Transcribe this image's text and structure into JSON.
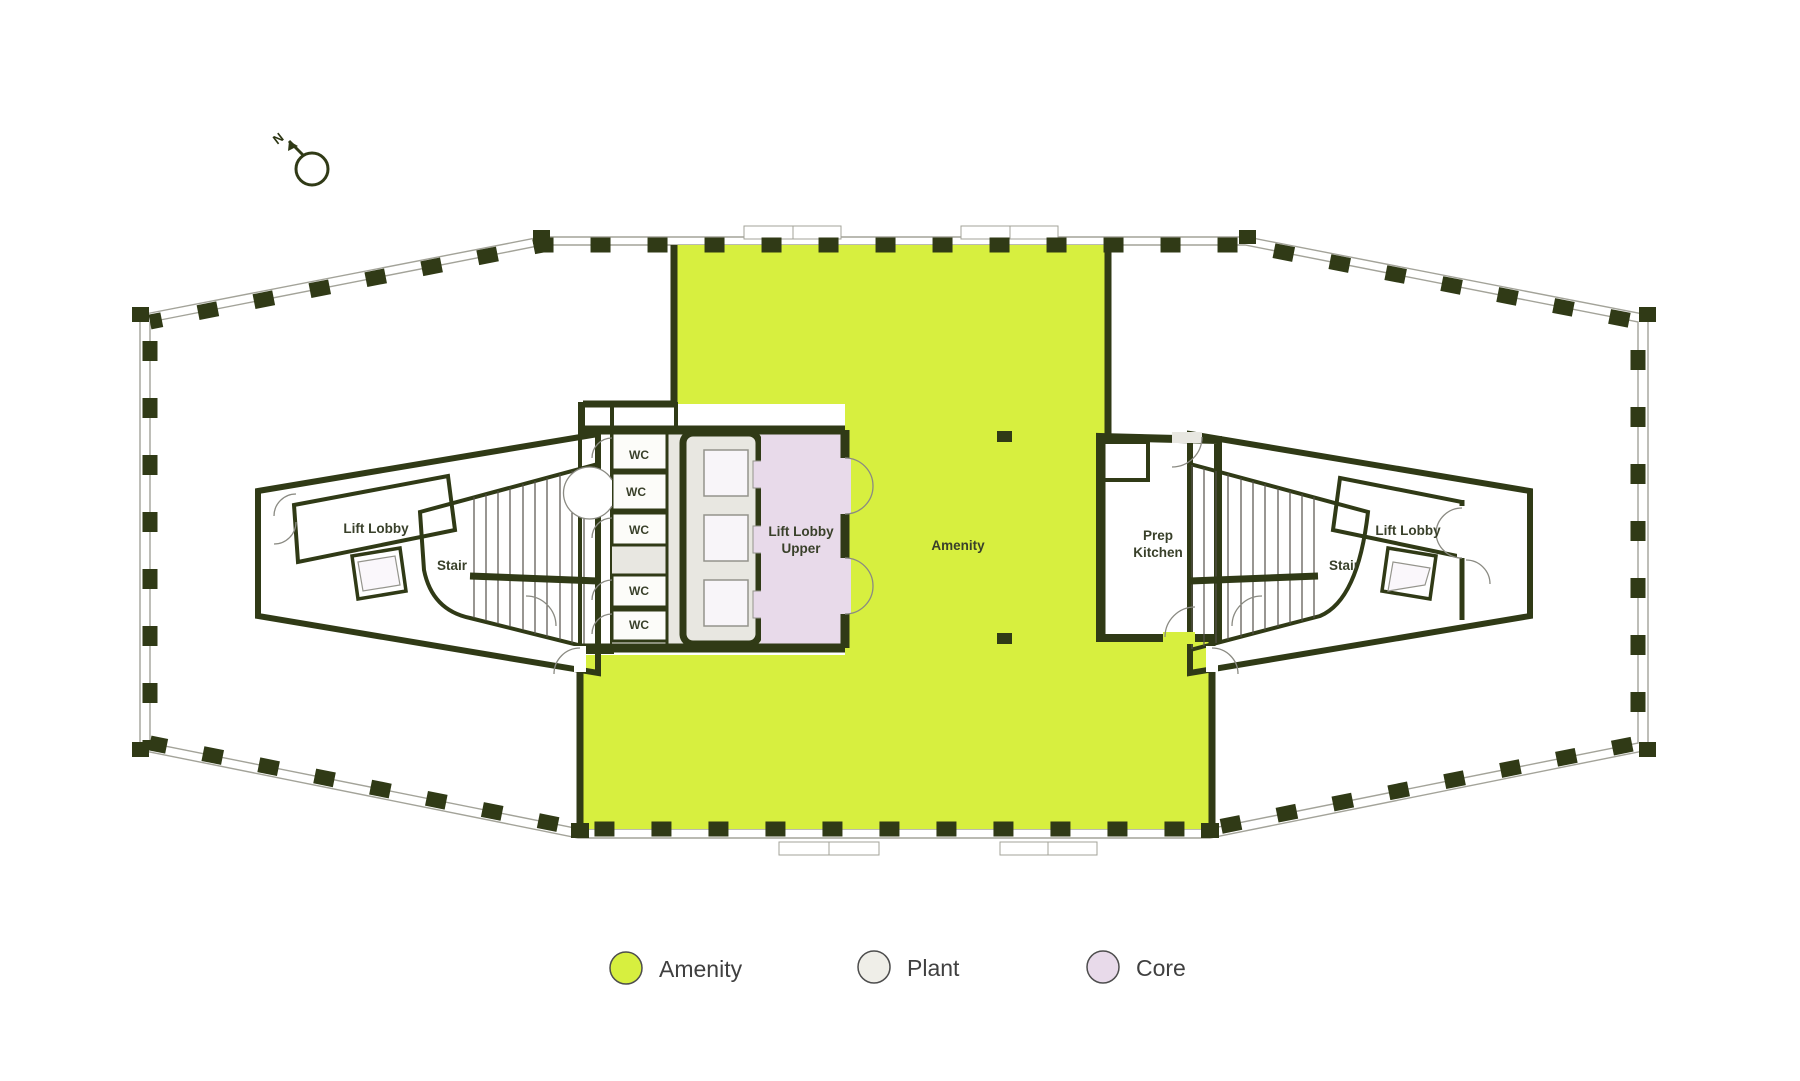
{
  "title": "Floor plan with amenity, plant and core zones",
  "colors": {
    "amenity": "#d7ef3f",
    "plant": "#efeee8",
    "core": "#e8daea",
    "wall": "#303a16",
    "floor": "#e8e7e1",
    "facade_line": "#a3a399",
    "white_room": "#ffffff",
    "label_text": "#39402a",
    "legend_text": "#404040"
  },
  "compass": {
    "north_label": "N"
  },
  "floorplan": {
    "labels": {
      "left_lift_lobby": "Lift Lobby",
      "left_stair": "Stair",
      "wc1": "WC",
      "wc2": "WC",
      "wc3": "WC",
      "wc4": "WC",
      "wc5": "WC",
      "lift_lobby_upper_line1": "Lift Lobby",
      "lift_lobby_upper_line2": "Upper",
      "amenity": "Amenity",
      "prep_kitchen_line1": "Prep",
      "prep_kitchen_line2": "Kitchen",
      "right_stair": "Stair",
      "right_lift_lobby": "Lift Lobby"
    }
  },
  "legend": {
    "items": [
      {
        "label": "Amenity",
        "color": "#d7ef3f"
      },
      {
        "label": "Plant",
        "color": "#efeee8"
      },
      {
        "label": "Core",
        "color": "#e8daea"
      }
    ]
  }
}
